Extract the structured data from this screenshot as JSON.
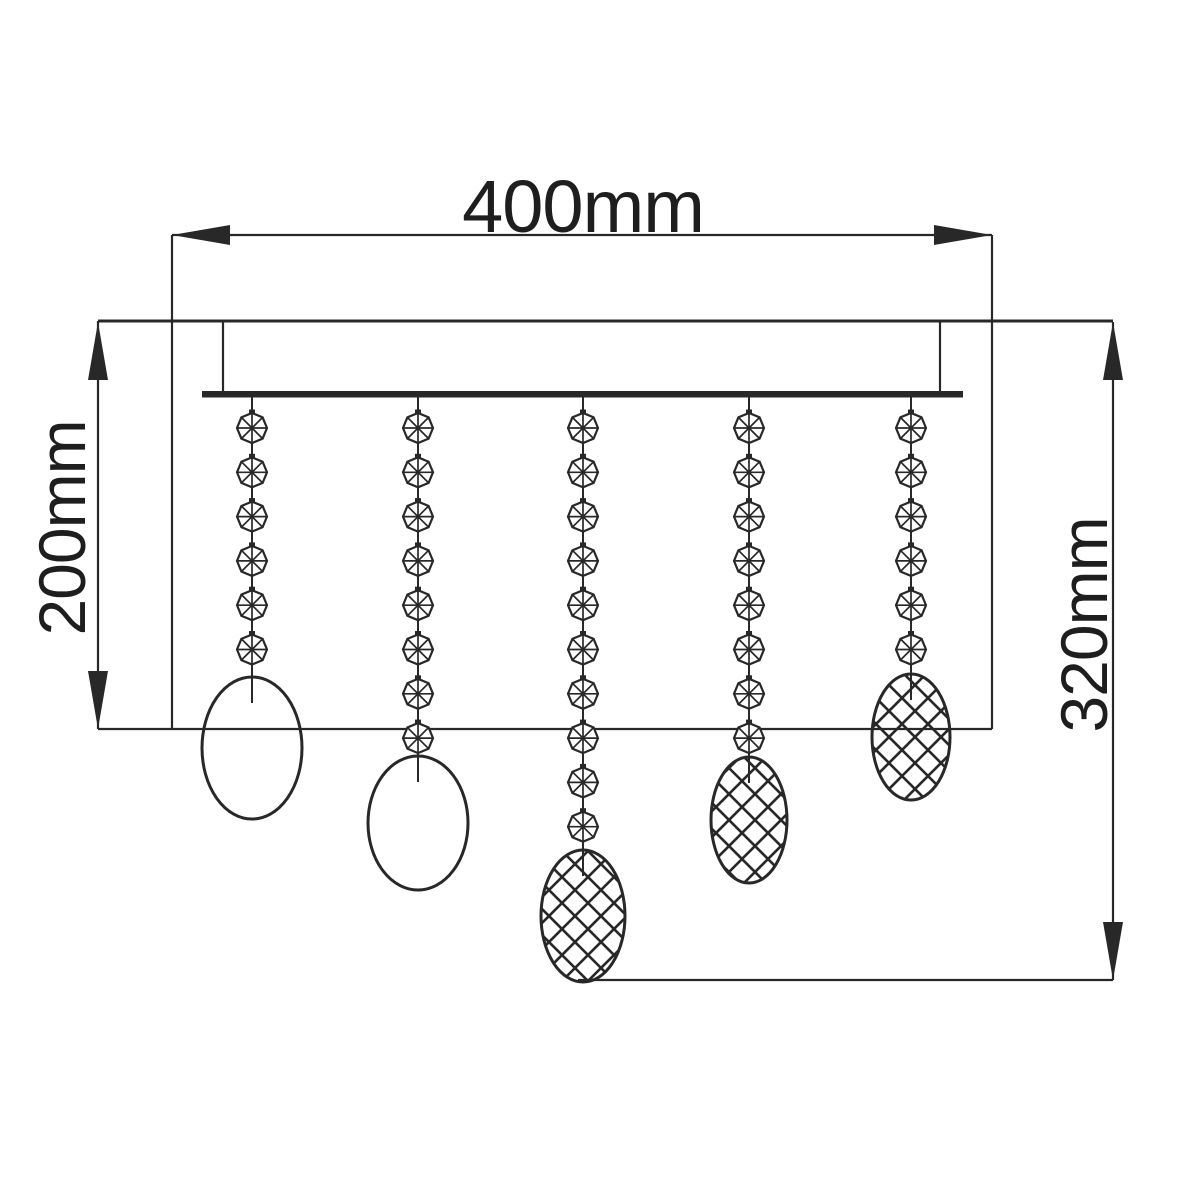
{
  "title": "Ceiling light fixture dimension drawing",
  "background": "#ffffff",
  "ink": "#282828",
  "dimensions": {
    "width_label": "400mm",
    "height_left_label": "200mm",
    "height_right_label": "320mm"
  },
  "figure": {
    "ceiling": {
      "y": 321,
      "x1": 98,
      "x2": 1113,
      "stroke_w": 3
    },
    "canopy": {
      "left": 223,
      "right": 940,
      "top": 321,
      "bottom": 391,
      "bar": {
        "x1": 202,
        "x2": 963,
        "y": 391,
        "h": 6.5
      }
    },
    "dim_width": {
      "y": 235,
      "x1": 172,
      "x2": 992,
      "ext_y2": 729
    },
    "dim_left": {
      "x": 98,
      "y1": 321,
      "y2": 729
    },
    "dim_right": {
      "x": 1113,
      "y1": 322,
      "y2": 980
    },
    "ref_line_left": {
      "y": 729,
      "x1": 98,
      "x2": 992
    },
    "ref_line_right": {
      "y": 980,
      "x1": 578,
      "x2": 1113
    },
    "beads": {
      "first_y": 428,
      "spacing": 44.3,
      "radius": 15
    },
    "strands": [
      {
        "x": 252,
        "bead_count": 6,
        "oval": {
          "cy": 748,
          "rx": 50,
          "ry": 71,
          "hatched": false
        }
      },
      {
        "x": 418,
        "bead_count": 8,
        "oval": {
          "cy": 823,
          "rx": 50,
          "ry": 67,
          "hatched": false
        }
      },
      {
        "x": 583,
        "bead_count": 10,
        "oval": {
          "cy": 916,
          "rx": 42,
          "ry": 66,
          "hatched": true
        }
      },
      {
        "x": 749,
        "bead_count": 8,
        "oval": {
          "cy": 820,
          "rx": 38,
          "ry": 63,
          "hatched": true
        }
      },
      {
        "x": 911,
        "bead_count": 6,
        "oval": {
          "cy": 737,
          "rx": 39,
          "ry": 63,
          "hatched": true
        }
      }
    ],
    "arrow": {
      "length": 58,
      "half_width": 10
    },
    "hatch_step": 26,
    "stroke_w": 2.2
  }
}
